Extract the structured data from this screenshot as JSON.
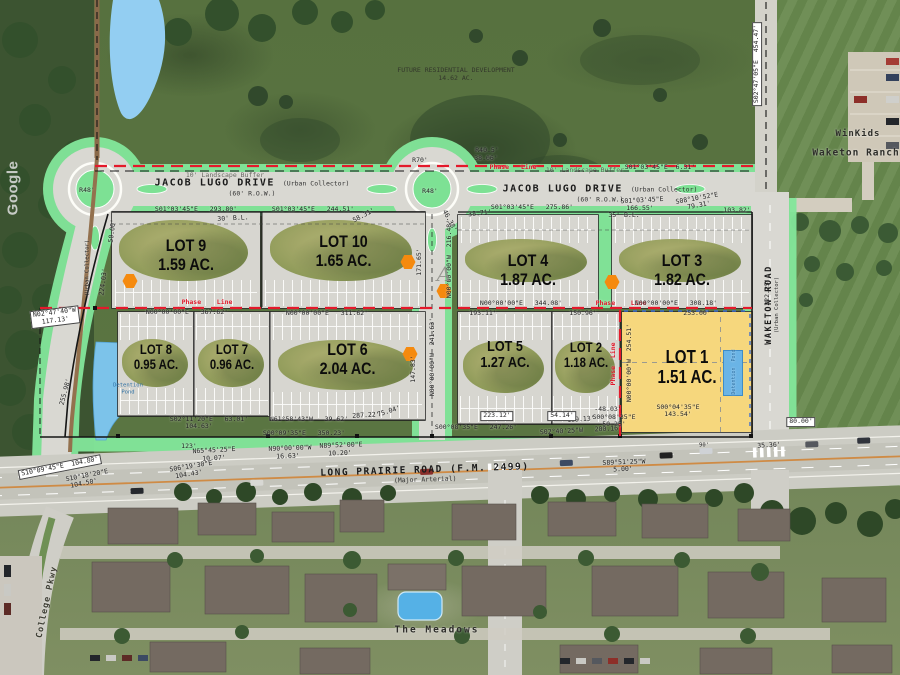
{
  "watermark": "Google",
  "future_dev": {
    "line1": "FUTURE RESIDENTIAL DEVELOPMENT",
    "line2": "14.62 AC."
  },
  "roads": {
    "jacob_lugo": {
      "name": "JACOB LUGO DRIVE",
      "row": "(60' R.O.W.)",
      "type": "(Urban Collector)"
    },
    "long_prairie": {
      "name": "LONG PRAIRIE ROAD (F.M. 2499)",
      "type": "(Major Arterial)"
    },
    "waketon": {
      "name": "WAKETON ROAD",
      "type": "(Urban Collector)"
    },
    "college_pkwy": "College Pkwy"
  },
  "places": {
    "winkids": "WinKids",
    "waketon_ranch": "Waketon Ranch",
    "the_meadows": "The Meadows",
    "detention": "Detention Pond"
  },
  "lots": [
    {
      "name": "LOT 9",
      "acres": "1.59 AC.",
      "x": 112,
      "y": 212,
      "w": 148,
      "h": 96,
      "park": "b",
      "lt": 26,
      "fs": 17
    },
    {
      "name": "LOT 10",
      "acres": "1.65 AC.",
      "x": 262,
      "y": 212,
      "w": 163,
      "h": 96,
      "park": "b",
      "lt": 22,
      "fs": 17
    },
    {
      "name": "LOT 4",
      "acres": "1.87 AC.",
      "x": 458,
      "y": 215,
      "w": 140,
      "h": 93,
      "park": "tb",
      "lt": 40,
      "fs": 17
    },
    {
      "name": "LOT 3",
      "acres": "1.82 AC.",
      "x": 612,
      "y": 215,
      "w": 140,
      "h": 93,
      "park": "tb",
      "lt": 40,
      "fs": 17
    },
    {
      "name": "LOT 8",
      "acres": "0.95 AC.",
      "x": 118,
      "y": 312,
      "w": 76,
      "h": 104,
      "park": "tb",
      "lt": 30,
      "fs": 13.5
    },
    {
      "name": "LOT 7",
      "acres": "0.96 AC.",
      "x": 194,
      "y": 312,
      "w": 76,
      "h": 104,
      "park": "tb",
      "lt": 30,
      "fs": 13.5
    },
    {
      "name": "LOT 6",
      "acres": "2.04 AC.",
      "x": 270,
      "y": 312,
      "w": 155,
      "h": 108,
      "park": "tb",
      "lt": 27,
      "fs": 17
    },
    {
      "name": "LOT 5",
      "acres": "1.27 AC.",
      "x": 458,
      "y": 312,
      "w": 94,
      "h": 112,
      "park": "tb",
      "lt": 24,
      "fs": 15
    },
    {
      "name": "LOT 2",
      "acres": "1.18 AC.",
      "x": 552,
      "y": 312,
      "w": 68,
      "h": 112,
      "park": "tb",
      "lt": 26,
      "fs": 13.5
    },
    {
      "name": "LOT 1",
      "acres": "1.51 AC.",
      "x": 622,
      "y": 312,
      "w": 130,
      "h": 120,
      "fill": "yellow",
      "lt": 30,
      "fs": 18
    }
  ],
  "markers": [
    {
      "x": 130,
      "y": 281
    },
    {
      "x": 408,
      "y": 262
    },
    {
      "x": 444,
      "y": 291
    },
    {
      "x": 612,
      "y": 282
    },
    {
      "x": 410,
      "y": 354
    }
  ],
  "dims": [
    {
      "t": "S01°03'45\"E   293.80'",
      "x": 196,
      "y": 210
    },
    {
      "t": "30' B.L.",
      "x": 233,
      "y": 219,
      "r": -3
    },
    {
      "t": "S01°03'45\"E   244.51'",
      "x": 313,
      "y": 210
    },
    {
      "t": "58.31'",
      "x": 364,
      "y": 216,
      "r": -28
    },
    {
      "t": "46.38'",
      "x": 449,
      "y": 221,
      "r": 62
    },
    {
      "t": "38.71'",
      "x": 480,
      "y": 214,
      "r": -6
    },
    {
      "t": "S01°03'45\"E   275.86'",
      "x": 532,
      "y": 208
    },
    {
      "t": "S01°03'45\"E",
      "x": 642,
      "y": 201,
      "r": -3
    },
    {
      "t": "166.55'",
      "x": 640,
      "y": 209
    },
    {
      "t": "S08°10'52\"E",
      "x": 697,
      "y": 199,
      "r": -10
    },
    {
      "t": "79.31'",
      "x": 699,
      "y": 206,
      "r": -10
    },
    {
      "t": "103.82'",
      "x": 737,
      "y": 211
    },
    {
      "t": "35' B.L.",
      "x": 624,
      "y": 216
    },
    {
      "t": "R40.5'",
      "x": 487,
      "y": 151
    },
    {
      "t": "38.06'",
      "x": 486,
      "y": 159
    },
    {
      "t": "R70'",
      "x": 420,
      "y": 161
    },
    {
      "t": "R48'",
      "x": 430,
      "y": 192
    },
    {
      "t": "R48'",
      "x": 87,
      "y": 191
    },
    {
      "t": "10' Landscape Buffer",
      "x": 225,
      "y": 176,
      "c": "faint"
    },
    {
      "t": "10' Landscape Buffer",
      "x": 585,
      "y": 171,
      "c": "faint"
    },
    {
      "t": "S01°03'45\"E  6.31'",
      "x": 660,
      "y": 168
    },
    {
      "t": "Phase   Line",
      "x": 513,
      "y": 168,
      "c": "red"
    },
    {
      "t": "(Urban Collector)",
      "x": 88,
      "y": 268,
      "r": -90,
      "s": 5.5
    },
    {
      "t": "224.03'",
      "x": 104,
      "y": 282,
      "r": -83
    },
    {
      "t": "50.00'",
      "x": 113,
      "y": 231,
      "r": -83
    },
    {
      "t": "255.98'",
      "x": 66,
      "y": 392,
      "r": -75
    },
    {
      "t": "N02°47'40\"W\n117.13'",
      "x": 55,
      "y": 317,
      "r": -7,
      "bg": 1
    },
    {
      "t": "Phase    Line",
      "x": 207,
      "y": 303,
      "c": "red"
    },
    {
      "t": "N00°00'00\"E   367.62'",
      "x": 187,
      "y": 313
    },
    {
      "t": "N00°00'00\"E   311.62'",
      "x": 327,
      "y": 314
    },
    {
      "t": "N00°00'00\"E   344.08'",
      "x": 521,
      "y": 304
    },
    {
      "t": "193.11'",
      "x": 483,
      "y": 314
    },
    {
      "t": "150.96'",
      "x": 583,
      "y": 314
    },
    {
      "t": "Phase    Line",
      "x": 621,
      "y": 304,
      "c": "red"
    },
    {
      "t": "N00°00'00\"E   308.18'",
      "x": 676,
      "y": 304
    },
    {
      "t": "253.00'",
      "x": 697,
      "y": 314
    },
    {
      "t": "N00°00'00\"W  216.48'",
      "x": 450,
      "y": 259,
      "r": -90
    },
    {
      "t": "171.65'",
      "x": 420,
      "y": 262,
      "r": -90
    },
    {
      "t": "N00°00'00\"W  241.63'",
      "x": 433,
      "y": 357,
      "r": -90
    },
    {
      "t": "147.83'",
      "x": 414,
      "y": 369,
      "r": -90
    },
    {
      "t": "Phase  Line",
      "x": 614,
      "y": 364,
      "r": -90,
      "c": "red"
    },
    {
      "t": "N00°00'00\"W  254.51'",
      "x": 630,
      "y": 363,
      "r": -90
    },
    {
      "t": "Detention  Pond",
      "x": 734,
      "y": 372,
      "r": -90,
      "c": "blue",
      "s": 5
    },
    {
      "t": "-48.03'",
      "x": 608,
      "y": 410
    },
    {
      "t": "S00°08'35\"E",
      "x": 614,
      "y": 418
    },
    {
      "t": "50.25'",
      "x": 614,
      "y": 425
    },
    {
      "t": "S00°04'35\"E",
      "x": 678,
      "y": 408
    },
    {
      "t": "143.54'",
      "x": 678,
      "y": 415
    },
    {
      "t": "159.13'",
      "x": 581,
      "y": 420,
      "r": -4
    },
    {
      "t": "S02°40'25\"W   200.16'",
      "x": 581,
      "y": 431,
      "r": -3
    },
    {
      "t": "80.00'",
      "x": 801,
      "y": 422,
      "bg": 1
    },
    {
      "t": "35.36'",
      "x": 769,
      "y": 446,
      "r": -3
    },
    {
      "t": "S89°51'25\"W",
      "x": 624,
      "y": 463,
      "r": -2
    },
    {
      "t": "5.00'",
      "x": 623,
      "y": 470,
      "r": -2
    },
    {
      "t": "N89°52'00\"E",
      "x": 341,
      "y": 446,
      "r": -2
    },
    {
      "t": "10.20'",
      "x": 340,
      "y": 454,
      "r": -2
    },
    {
      "t": "N90°00'00\"W",
      "x": 290,
      "y": 449,
      "r": -2
    },
    {
      "t": "16.63'",
      "x": 288,
      "y": 457,
      "r": -2
    },
    {
      "t": "123'",
      "x": 189,
      "y": 447
    },
    {
      "t": "N65°45'25\"E",
      "x": 214,
      "y": 451,
      "r": -3
    },
    {
      "t": "10.07'",
      "x": 214,
      "y": 459,
      "r": -3
    },
    {
      "t": "S06°19'30\"E",
      "x": 191,
      "y": 467,
      "r": -9
    },
    {
      "t": "104.43'",
      "x": 189,
      "y": 475,
      "r": -9
    },
    {
      "t": "S10°09'45\"E  104.80'",
      "x": 60,
      "y": 467,
      "r": -11,
      "bg": 1
    },
    {
      "t": "S10°18'20\"E",
      "x": 87,
      "y": 476,
      "r": -11
    },
    {
      "t": "104.50'",
      "x": 84,
      "y": 484,
      "r": -11
    },
    {
      "t": "S00°09'35\"E   350.23'",
      "x": 304,
      "y": 434
    },
    {
      "t": "S00°08'35\"E   247.26'",
      "x": 476,
      "y": 428
    },
    {
      "t": "287.22'",
      "x": 366,
      "y": 416,
      "r": -3
    },
    {
      "t": "75.04'",
      "x": 389,
      "y": 412,
      "r": -18
    },
    {
      "t": "S02°11'20\"E   63.01'",
      "x": 209,
      "y": 420
    },
    {
      "t": "104.63'",
      "x": 199,
      "y": 427
    },
    {
      "t": "N61°58'43\"W   39.62'",
      "x": 309,
      "y": 420
    },
    {
      "t": "223.12'",
      "x": 497,
      "y": 416,
      "bg": 1
    },
    {
      "t": "54.14'",
      "x": 562,
      "y": 416,
      "bg": 1
    },
    {
      "t": "S02°47'05\"E  454.47'",
      "x": 757,
      "y": 64,
      "r": -90,
      "bg": 1
    },
    {
      "t": "222.25'",
      "x": 768,
      "y": 292,
      "r": -90
    },
    {
      "t": "90'",
      "x": 704,
      "y": 446,
      "s": 5.5
    },
    {
      "t": "A",
      "x": 444,
      "y": 274,
      "c": "match"
    }
  ]
}
